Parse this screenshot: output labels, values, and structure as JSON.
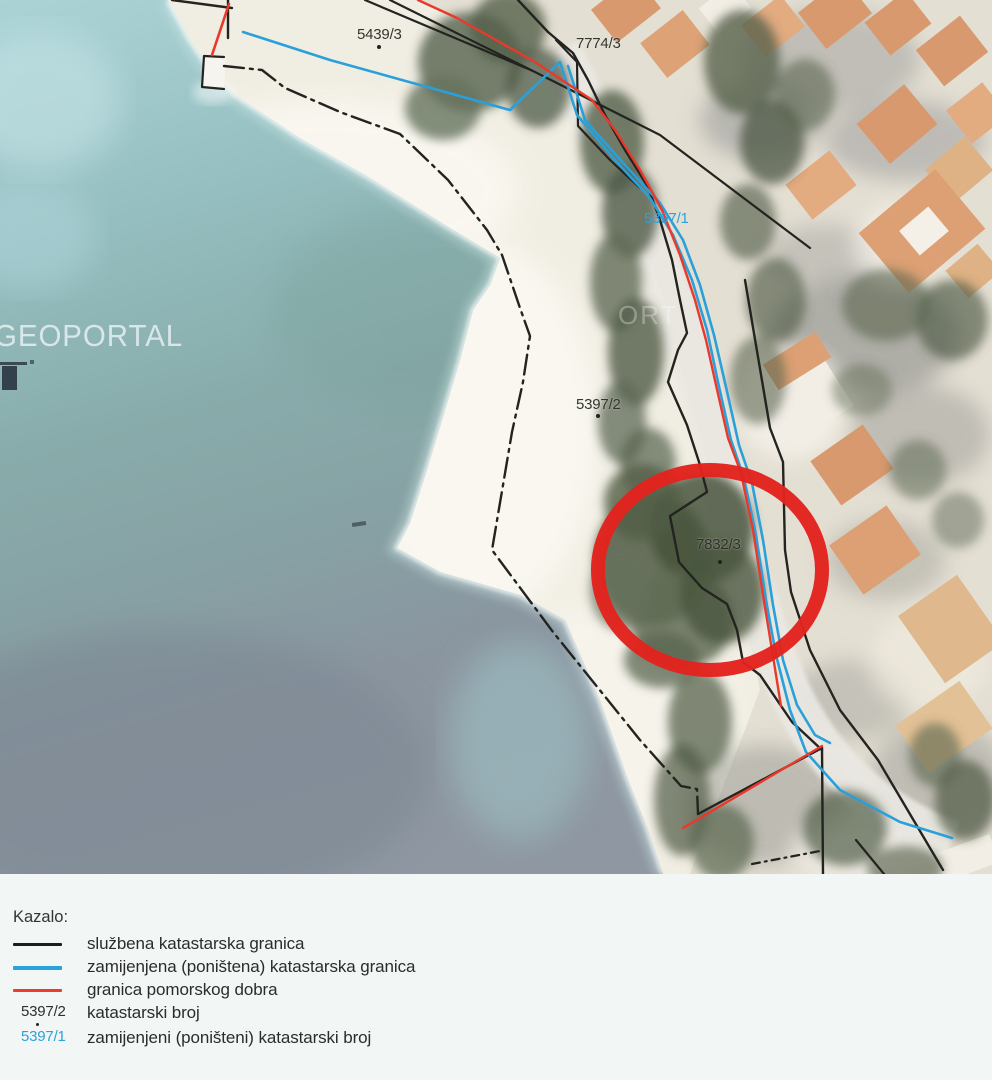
{
  "map": {
    "watermark_text": "GEOPORTAL",
    "watermark_fragment": "ORT",
    "labels": {
      "p5439": "5439/3",
      "p7774": "7774/3",
      "p5397_1": "5397/1",
      "p5397_2": "5397/2",
      "p7832": "7832/3"
    }
  },
  "legend": {
    "title": "Kazalo:",
    "entries": [
      {
        "swatch": "black-line",
        "color": "#1d1d1b",
        "label": "službena katastarska granica"
      },
      {
        "swatch": "blue-line",
        "color": "#2aa2dc",
        "label": "zamijenjena (poništena) katastarska granica"
      },
      {
        "swatch": "red-line",
        "color": "#ef3a2d",
        "label": "granica pomorskog dobra"
      },
      {
        "swatch": "number",
        "text": "5397/2",
        "color": "#2f2f2d",
        "label": "katastarski broj"
      },
      {
        "swatch": "number",
        "text": "5397/1",
        "color": "#2aa2dc",
        "label": "zamijenjeni (poništeni) katastarski broj"
      }
    ]
  },
  "colors": {
    "boundary_black": "#1d1d1b",
    "boundary_blue": "#2aa2dc",
    "maritime_red": "#ef3a2d",
    "annotation_circle_red": "#e2231e",
    "sea_turquoise": "#95bec0",
    "sea_slate": "#8e97a2",
    "sand": "#f0ede2"
  }
}
